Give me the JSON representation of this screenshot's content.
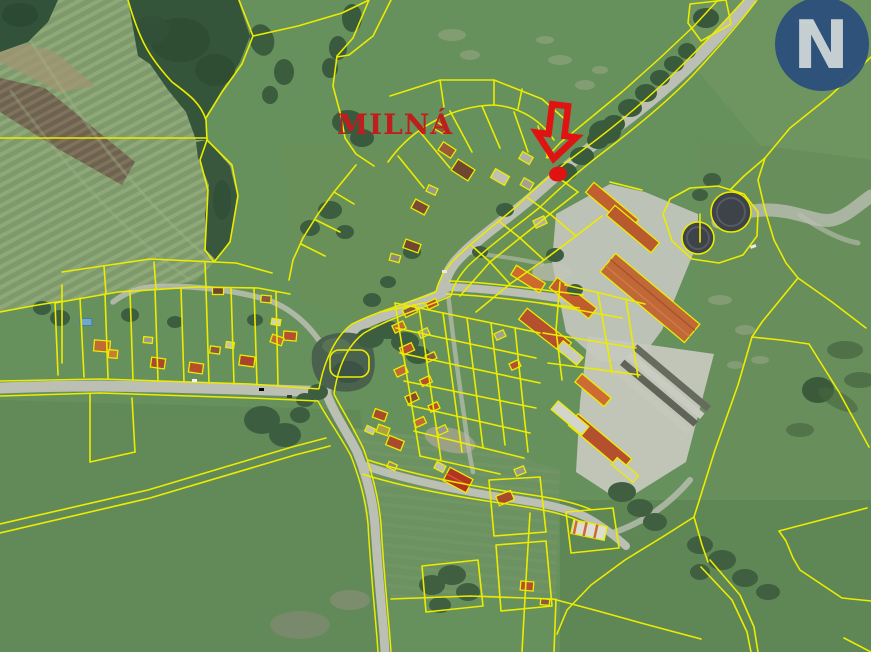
{
  "map": {
    "place_label": "MILNÁ",
    "label_color": "#bf1e1e",
    "marker": {
      "name": "property-location-marker",
      "arrow_color": "#e01313",
      "dot_color": "#e01313"
    },
    "watermark": {
      "letter": "N",
      "circle_color": "#2a4e7d",
      "letter_color": "#ccd4da",
      "opacity": 0.93
    },
    "legend_colors": {
      "cadastral_line": "#ecec00",
      "road": "#bcbfb3",
      "water": "#49614d",
      "forest": "#35553a",
      "pasture": "#66905c",
      "roof_orange": "#b5502f"
    },
    "features": [
      "aerial-photo-background",
      "cadastral-parcel-lines",
      "village-buildings",
      "farm-complex",
      "storage-tanks",
      "pond",
      "roads",
      "striped-field",
      "forest"
    ]
  }
}
